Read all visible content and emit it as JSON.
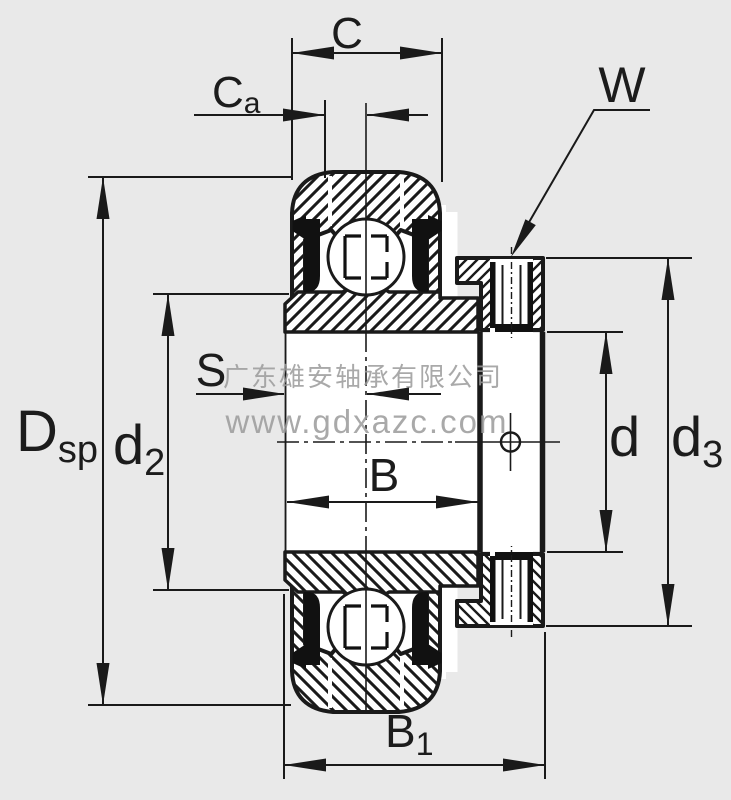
{
  "drawing": {
    "type": "bearing cross-section",
    "description": "Radial insert ball bearing with eccentric locking collar and set screw, axial section view"
  },
  "watermark": {
    "company": "广东雄安轴承有限公司",
    "website": "www.gdxazc.com"
  },
  "labels": {
    "c": {
      "main": "C",
      "sub": ""
    },
    "c_a": {
      "main": "C",
      "sub": "a"
    },
    "w": {
      "main": "W",
      "sub": ""
    },
    "s": {
      "main": "S",
      "sub": ""
    },
    "b": {
      "main": "B",
      "sub": ""
    },
    "b_1": {
      "main": "B",
      "sub": "1"
    },
    "d_sp": {
      "main": "D",
      "sub": "sp"
    },
    "d_2": {
      "main": "d",
      "sub": "2"
    },
    "d": {
      "main": "d",
      "sub": ""
    },
    "d_3": {
      "main": "d",
      "sub": "3"
    }
  },
  "colors": {
    "background": "#e9e9e9",
    "line": "#1a1a1a",
    "watermark": "#9b9b9b",
    "fill_white": "#ffffff"
  }
}
